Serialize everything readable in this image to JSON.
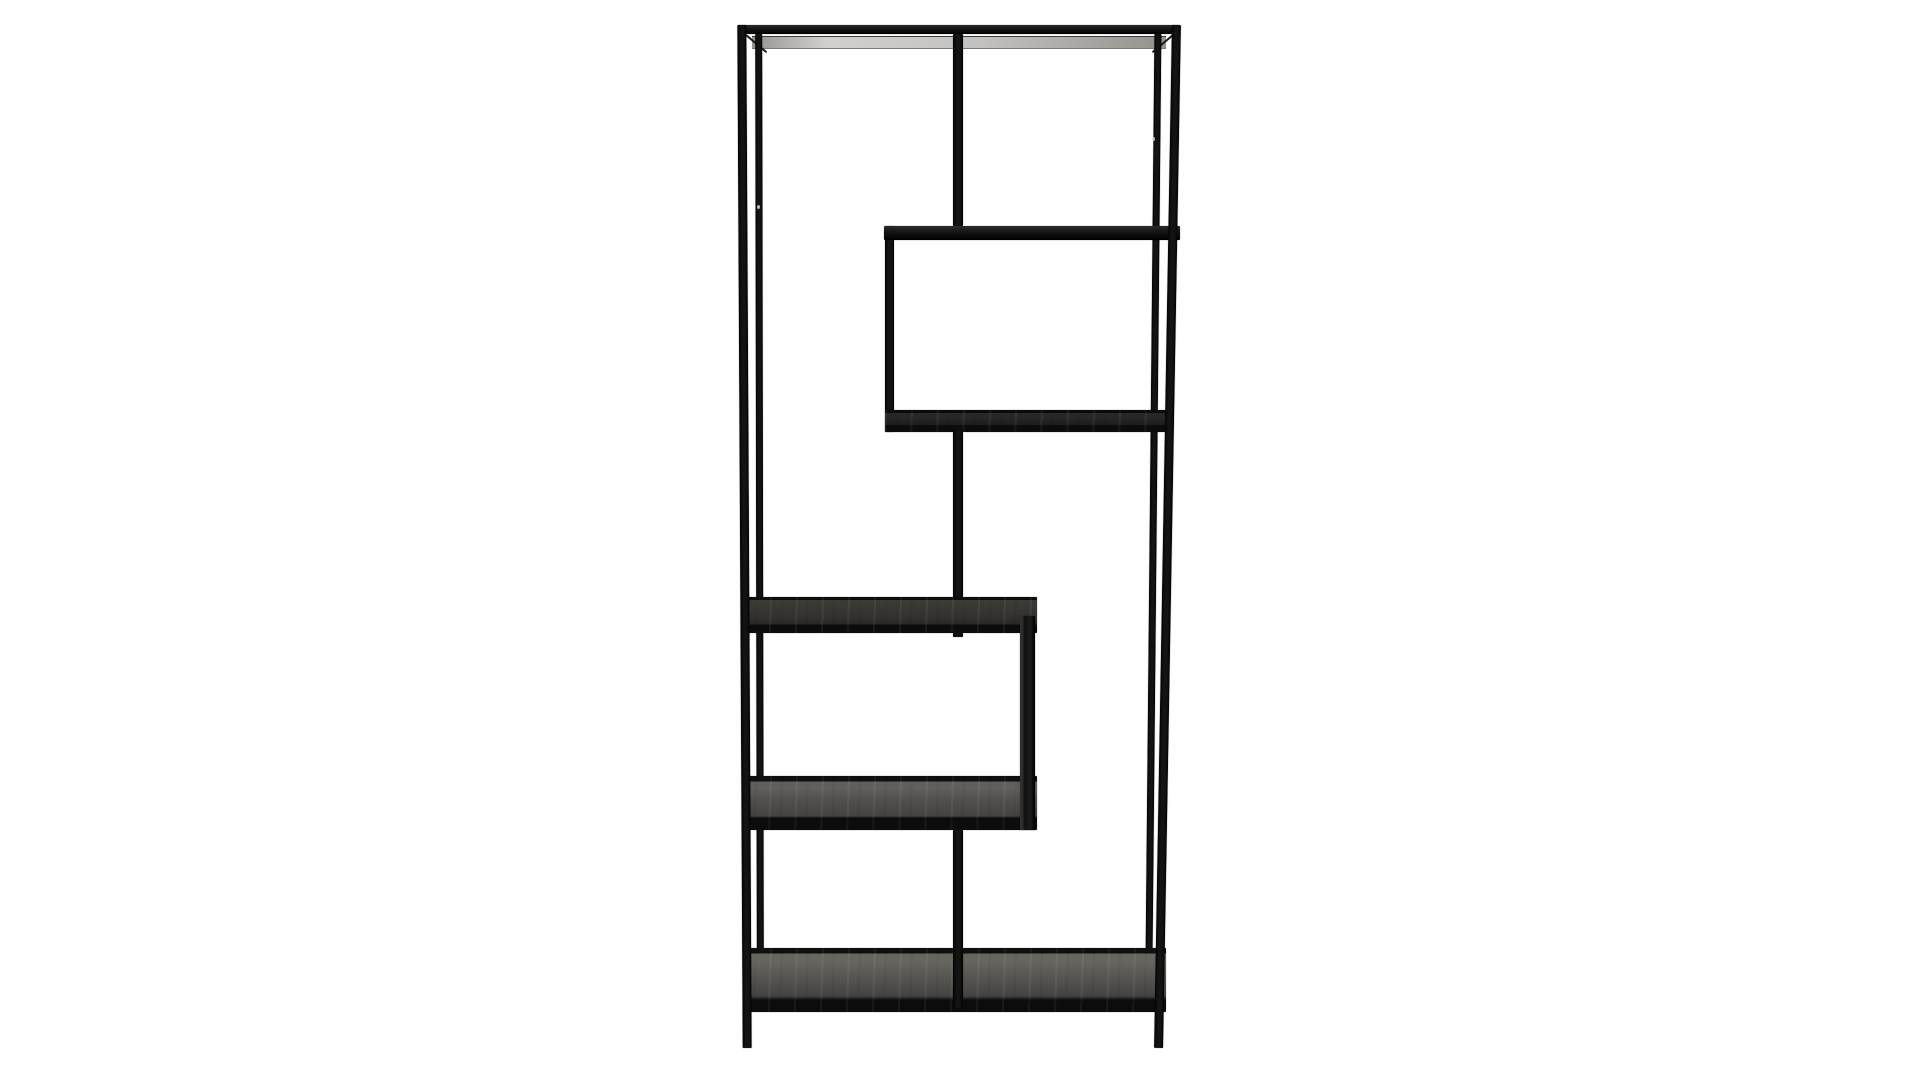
{
  "scene": {
    "type": "product-photo",
    "subject": "Asymmetric black metal etagere bookcase with offset wood shelves",
    "background": "plain white studio backdrop",
    "text_content": ""
  },
  "colors": {
    "bg": "#ffffff",
    "frame": "#131313",
    "frame-edge": "#2b2b2b",
    "band": "#0c0c0c",
    "wood-light": "#615f5b",
    "wood-mid": "#454340",
    "wood-dark": "#262422",
    "underside-light": "#d2d0ce",
    "underside-dark": "#96948f",
    "screw": "#d8d8d8"
  }
}
